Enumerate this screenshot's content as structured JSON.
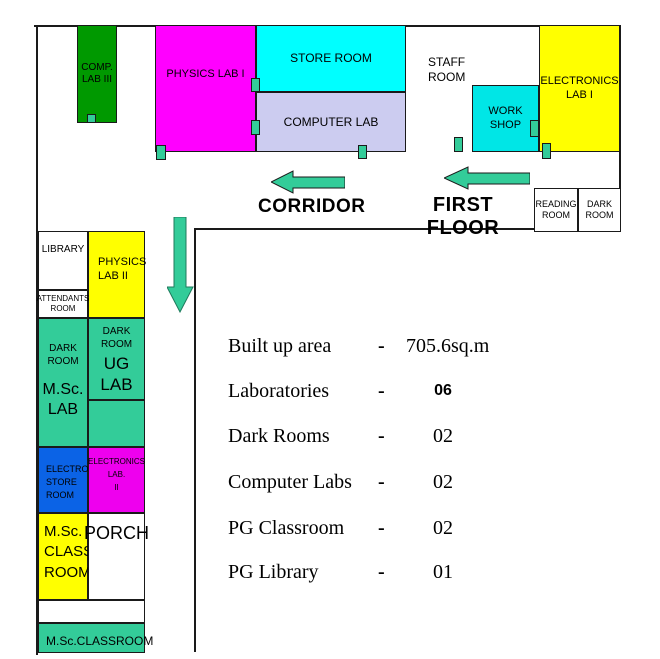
{
  "palette": {
    "wall": "#1A1A1A",
    "green": "#009900",
    "magenta": "#FF00FF",
    "magenta_dark": "#EE00EE",
    "cyan": "#00FFFF",
    "workshop_cyan": "#00E6E6",
    "lavender": "#CCCCF0",
    "yellow": "#FFFF00",
    "teal": "#33CC99",
    "blue": "#0B63E6"
  },
  "floorplan": {
    "rooms": {
      "comp_lab_3": {
        "label": "COMP.\nLAB III"
      },
      "physics_lab_1": {
        "label": "PHYSICS LAB I"
      },
      "store_room": {
        "label": "STORE ROOM"
      },
      "computer_lab": {
        "label": "COMPUTER LAB"
      },
      "staff_room": {
        "label": "STAFF\nROOM"
      },
      "work_shop": {
        "label": "WORK\nSHOP"
      },
      "electronics_lab_1": {
        "label": "ELECTRONICS\nLAB I"
      },
      "reading_room": {
        "label": "READING\nROOM"
      },
      "dark_room_first_floor": {
        "label": "DARK\nROOM"
      },
      "library": {
        "label": "LIBRARY"
      },
      "physics_lab_2": {
        "label": "PHYSICS\nLAB II"
      },
      "attendants_room": {
        "label": "ATTENDANTS\nROOM"
      },
      "msc_lab": {
        "label_top": "DARK\nROOM",
        "label_bottom": "M.Sc.\nLAB"
      },
      "ug_lab": {
        "label_top": "DARK\nROOM",
        "label_bottom": "UG\nLAB"
      },
      "electro_store_room": {
        "label": "ELECTRO.\nSTORE\nROOM"
      },
      "electronics_lab_2": {
        "label": "ELECTRONICS\nLAB.\nII"
      },
      "msc_class_room": {
        "label": "M.Sc.\nCLASS\nROOM"
      },
      "porch": {
        "label": "PORCH"
      },
      "msc_classroom_strip": {
        "label": "M.Sc.CLASSROOM"
      }
    },
    "labels": {
      "corridor": "CORRIDOR",
      "first_floor": "FIRST FLOOR"
    }
  },
  "stats": {
    "rows": [
      {
        "label": "Built up area",
        "sep": "-",
        "value": "705.6sq.m"
      },
      {
        "label": "Laboratories",
        "sep": "-",
        "value": "06"
      },
      {
        "label": "Dark Rooms",
        "sep": "-",
        "value": "02"
      },
      {
        "label": "Computer Labs",
        "sep": "-",
        "value": "02"
      },
      {
        "label": "PG Classroom",
        "sep": "-",
        "value": "02"
      },
      {
        "label": "PG Library",
        "sep": "-",
        "value": "01"
      }
    ]
  }
}
